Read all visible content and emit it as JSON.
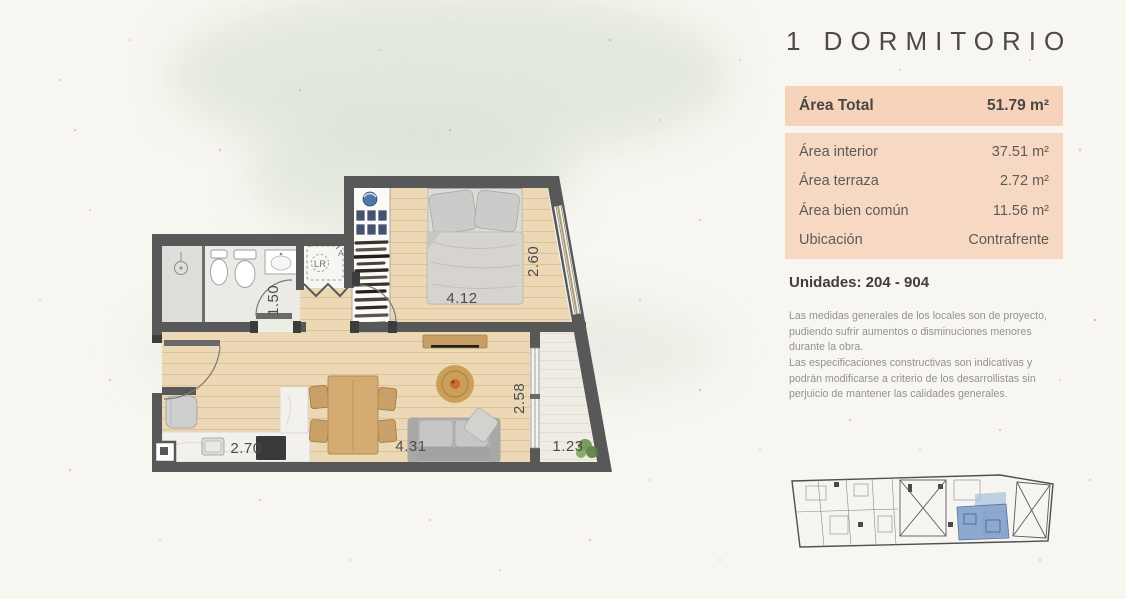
{
  "title": "1 DORMITORIO",
  "area_total": {
    "label": "Área Total",
    "value": "51.79 m²"
  },
  "area_rows": [
    {
      "label": "Área interior",
      "value": "37.51 m²"
    },
    {
      "label": "Área terraza",
      "value": "2.72 m²"
    },
    {
      "label": "Área bien común",
      "value": "11.56 m²"
    },
    {
      "label": "Ubicación",
      "value": "Contrafrente"
    }
  ],
  "unidades": "Unidades: 204 - 904",
  "disclaimer": [
    "Las medidas generales de los locales son de proyecto, pudiendo sufrir aumentos o disminuciones menores durante la obra.",
    "Las especificaciones constructivas son indicativas y podrán modificarse a criterio de los desarrollistas sin perjuicio de mantener las calidades generales."
  ],
  "floorplan": {
    "dims": {
      "bath_width": "1.50",
      "bed_width": "4.12",
      "bed_depth": "2.60",
      "living_depth": "2.58",
      "kitchen_width": "2.70",
      "living_width": "4.31",
      "terrace_width": "1.23"
    },
    "labels": {
      "laundry": "LR",
      "shaft": "A"
    }
  },
  "colors": {
    "accent_peach": "#f6d3ba",
    "accent_peach_light": "#f7d9c3",
    "wall_gray": "#585858",
    "wood_floor": "#ecd8b4",
    "unit_highlight_blue": "#7b9cc9",
    "title_gray": "#4d4a47"
  }
}
